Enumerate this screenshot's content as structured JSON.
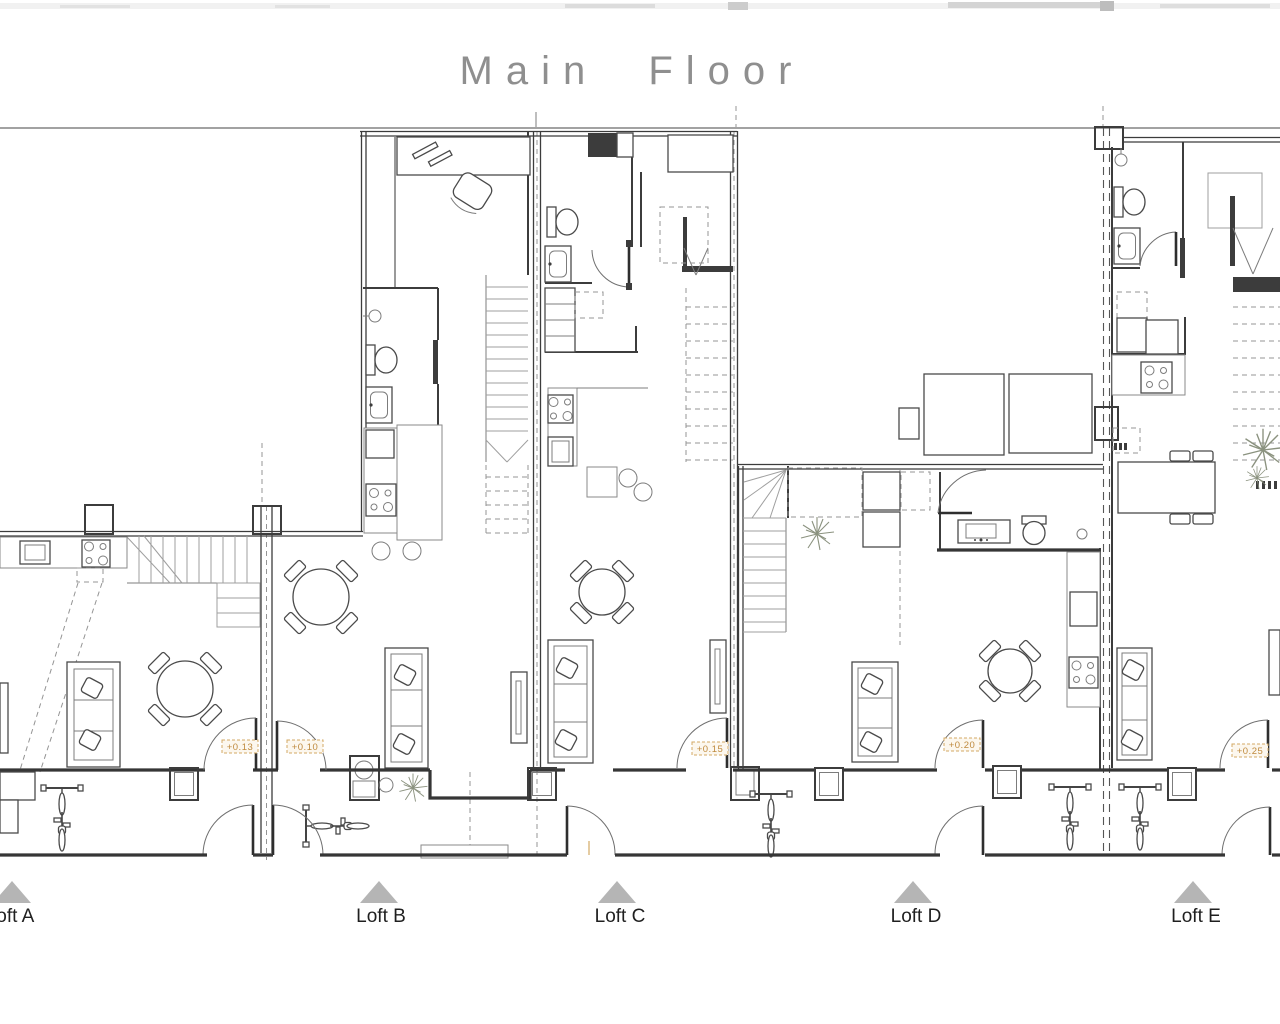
{
  "title": "Main Floor",
  "lofts": [
    {
      "id": "A",
      "label": "Loft A",
      "elevation": "+0.13"
    },
    {
      "id": "B",
      "label": "Loft B",
      "elevation": "+0.10"
    },
    {
      "id": "C",
      "label": "Loft C",
      "elevation": "+0.15"
    },
    {
      "id": "D",
      "label": "Loft D",
      "elevation": "+0.20"
    },
    {
      "id": "E",
      "label": "Loft E",
      "elevation": "+0.25"
    }
  ],
  "colors": {
    "wall": "#363636",
    "light_line": "#9a9a9a",
    "title_text": "#8f8f8f",
    "label_text": "#1f1f1f",
    "elevation_text": "#bf8a3e",
    "elevation_box_border": "#d3a964",
    "triangle": "#b5b5b5",
    "plant": "#8b927f"
  }
}
